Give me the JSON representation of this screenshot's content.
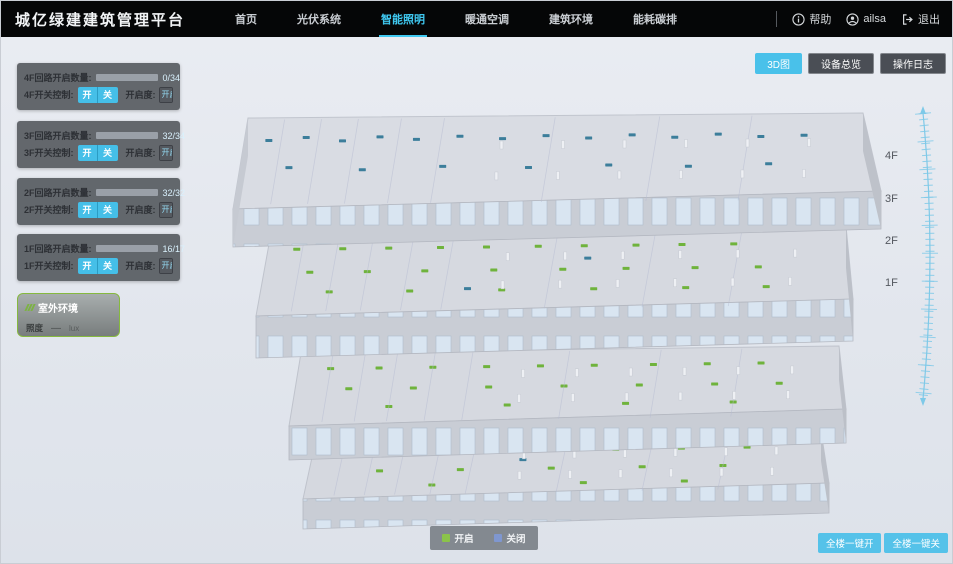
{
  "header": {
    "title": "城亿绿建建筑管理平台",
    "nav": [
      {
        "label": "首页",
        "active": false
      },
      {
        "label": "光伏系统",
        "active": false
      },
      {
        "label": "智能照明",
        "active": true
      },
      {
        "label": "暖通空调",
        "active": false
      },
      {
        "label": "建筑环境",
        "active": false
      },
      {
        "label": "能耗碳排",
        "active": false
      }
    ],
    "help_label": "帮助",
    "user_name": "ailsa",
    "logout_label": "退出"
  },
  "toolbar": {
    "view3d_label": "3D图",
    "device_overview_label": "设备总览",
    "operation_log_label": "操作日志"
  },
  "floors_panel": [
    {
      "circuit_label": "4F回路开启数量:",
      "open": 0,
      "total": 34,
      "value_text": "0/34",
      "switch_label": "4F开关控制:",
      "on_label": "开",
      "off_label": "关",
      "openness_label": "开启度:",
      "openness_placeholder": "开启度",
      "percent_label": "%"
    },
    {
      "circuit_label": "3F回路开启数量:",
      "open": 32,
      "total": 34,
      "value_text": "32/34",
      "switch_label": "3F开关控制:",
      "on_label": "开",
      "off_label": "关",
      "openness_label": "开启度:",
      "openness_placeholder": "开启度",
      "percent_label": "%"
    },
    {
      "circuit_label": "2F回路开启数量:",
      "open": 32,
      "total": 32,
      "value_text": "32/32",
      "switch_label": "2F开关控制:",
      "on_label": "开",
      "off_label": "关",
      "openness_label": "开启度:",
      "openness_placeholder": "开启度",
      "percent_label": "%"
    },
    {
      "circuit_label": "1F回路开启数量:",
      "open": 16,
      "total": 17,
      "value_text": "16/17",
      "switch_label": "1F开关控制:",
      "on_label": "开",
      "off_label": "关",
      "openness_label": "开启度:",
      "openness_placeholder": "开启度",
      "percent_label": "%"
    }
  ],
  "outdoor": {
    "title": "室外环境",
    "illuminance_label": "照度",
    "illuminance_value": "—",
    "illuminance_unit": "lux"
  },
  "floor_scale": {
    "labels": [
      "4F",
      "3F",
      "2F",
      "1F"
    ]
  },
  "legend": {
    "on_label": "开启",
    "off_label": "关闭",
    "on_color": "#8bc34a",
    "off_color": "#7f97d0"
  },
  "bottom_actions": {
    "all_on_label": "全楼一键开",
    "all_off_label": "全楼一键关"
  },
  "building": {
    "on_color": "#6fb33c",
    "off_color": "#3c7e9b",
    "floors": [
      {
        "key": "f4",
        "name": "4F",
        "on_dots": [],
        "off_dots": [
          [
            0.04,
            0.25
          ],
          [
            0.1,
            0.22
          ],
          [
            0.16,
            0.26
          ],
          [
            0.22,
            0.22
          ],
          [
            0.28,
            0.25
          ],
          [
            0.35,
            0.22
          ],
          [
            0.42,
            0.25
          ],
          [
            0.49,
            0.22
          ],
          [
            0.56,
            0.25
          ],
          [
            0.63,
            0.22
          ],
          [
            0.7,
            0.25
          ],
          [
            0.77,
            0.22
          ],
          [
            0.84,
            0.25
          ],
          [
            0.91,
            0.24
          ],
          [
            0.08,
            0.55
          ],
          [
            0.2,
            0.58
          ],
          [
            0.33,
            0.55
          ],
          [
            0.47,
            0.57
          ],
          [
            0.6,
            0.55
          ],
          [
            0.73,
            0.57
          ],
          [
            0.86,
            0.55
          ]
        ]
      },
      {
        "key": "f3",
        "name": "3F",
        "on_dots": [
          [
            0.05,
            0.2
          ],
          [
            0.13,
            0.2
          ],
          [
            0.21,
            0.2
          ],
          [
            0.3,
            0.2
          ],
          [
            0.38,
            0.2
          ],
          [
            0.47,
            0.2
          ],
          [
            0.55,
            0.2
          ],
          [
            0.64,
            0.2
          ],
          [
            0.72,
            0.2
          ],
          [
            0.81,
            0.2
          ],
          [
            0.08,
            0.48
          ],
          [
            0.18,
            0.48
          ],
          [
            0.28,
            0.48
          ],
          [
            0.4,
            0.48
          ],
          [
            0.52,
            0.48
          ],
          [
            0.63,
            0.48
          ],
          [
            0.75,
            0.48
          ],
          [
            0.86,
            0.48
          ],
          [
            0.12,
            0.72
          ],
          [
            0.26,
            0.72
          ],
          [
            0.42,
            0.72
          ],
          [
            0.58,
            0.72
          ],
          [
            0.74,
            0.72
          ],
          [
            0.88,
            0.72
          ]
        ],
        "off_dots": [
          [
            0.56,
            0.35
          ],
          [
            0.36,
            0.7
          ]
        ]
      },
      {
        "key": "f2",
        "name": "2F",
        "on_dots": [
          [
            0.06,
            0.22
          ],
          [
            0.15,
            0.22
          ],
          [
            0.25,
            0.22
          ],
          [
            0.35,
            0.22
          ],
          [
            0.45,
            0.22
          ],
          [
            0.55,
            0.22
          ],
          [
            0.66,
            0.22
          ],
          [
            0.76,
            0.22
          ],
          [
            0.86,
            0.22
          ],
          [
            0.1,
            0.5
          ],
          [
            0.22,
            0.5
          ],
          [
            0.36,
            0.5
          ],
          [
            0.5,
            0.5
          ],
          [
            0.64,
            0.5
          ],
          [
            0.78,
            0.5
          ],
          [
            0.9,
            0.5
          ],
          [
            0.18,
            0.75
          ],
          [
            0.4,
            0.75
          ],
          [
            0.62,
            0.75
          ],
          [
            0.82,
            0.75
          ]
        ],
        "off_dots": []
      },
      {
        "key": "f1",
        "name": "1F",
        "on_dots": [
          [
            0.08,
            0.25
          ],
          [
            0.2,
            0.25
          ],
          [
            0.33,
            0.25
          ],
          [
            0.47,
            0.25
          ],
          [
            0.6,
            0.25
          ],
          [
            0.73,
            0.25
          ],
          [
            0.86,
            0.25
          ],
          [
            0.14,
            0.55
          ],
          [
            0.3,
            0.55
          ],
          [
            0.48,
            0.55
          ],
          [
            0.66,
            0.55
          ],
          [
            0.82,
            0.55
          ],
          [
            0.25,
            0.8
          ],
          [
            0.55,
            0.8
          ],
          [
            0.75,
            0.8
          ]
        ],
        "off_dots": [
          [
            0.42,
            0.4
          ]
        ]
      }
    ]
  }
}
